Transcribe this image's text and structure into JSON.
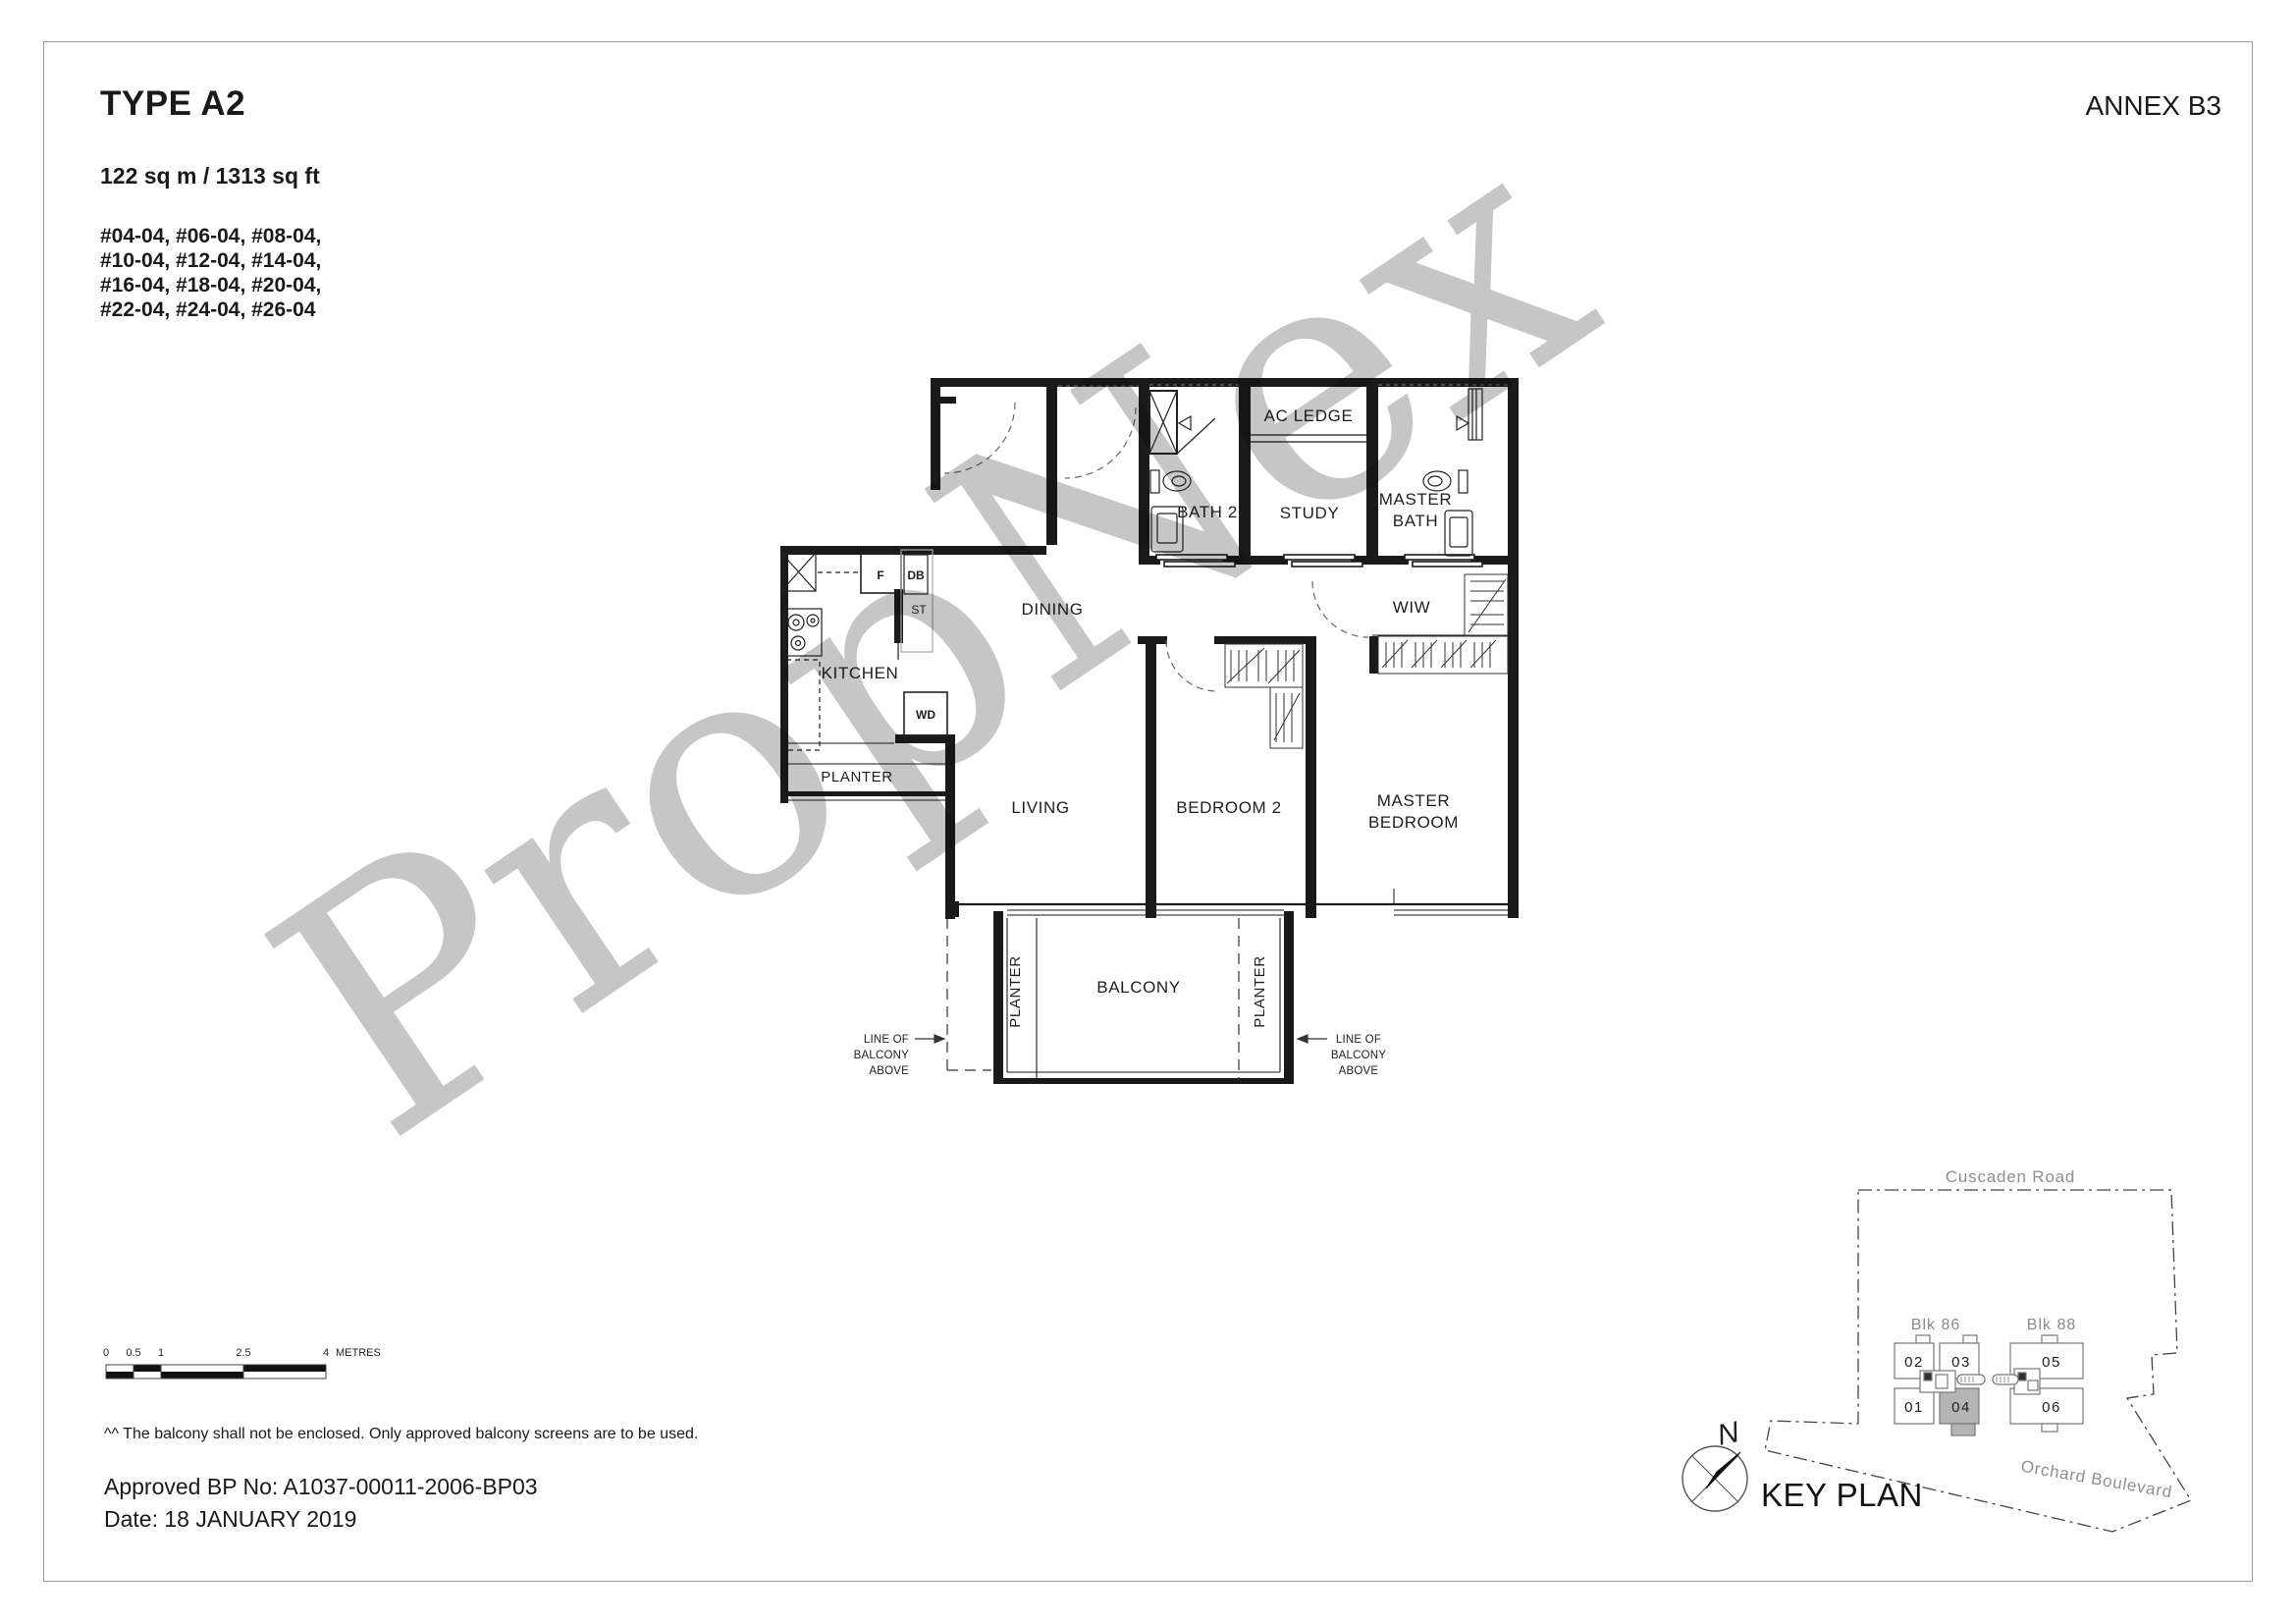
{
  "page": {
    "title": "TYPE A2",
    "annex": "ANNEX B3",
    "area": "122 sq m / 1313 sq ft",
    "units": [
      "#04-04, #06-04, #08-04,",
      "#10-04, #12-04, #14-04,",
      "#16-04, #18-04, #20-04,",
      "#22-04, #24-04, #26-04"
    ],
    "watermark": "PropNex",
    "note": "^^ The balcony shall not be enclosed. Only approved balcony screens are to be used.",
    "approval_bp": "Approved BP No: A1037-00011-2006-BP03",
    "approval_date": "Date: 18 JANUARY 2019"
  },
  "floorplan": {
    "rooms": {
      "ac_ledge": "AC LEDGE",
      "bath2": "BATH 2",
      "study": "STUDY",
      "master_bath": [
        "MASTER",
        "BATH"
      ],
      "dining": "DINING",
      "wiw": "WIW",
      "kitchen": "KITCHEN",
      "planter_kitchen": "PLANTER",
      "living": "LIVING",
      "bedroom2": "BEDROOM 2",
      "master_bedroom": [
        "MASTER",
        "BEDROOM"
      ],
      "balcony": "BALCONY",
      "planter_left": "PLANTER",
      "planter_right": "PLANTER"
    },
    "fixtures": {
      "fridge": "F",
      "distribution_board": "DB",
      "store": "ST",
      "washer_dryer": "WD"
    },
    "annotations": {
      "line_of_balcony_above": [
        "LINE OF",
        "BALCONY",
        "ABOVE"
      ]
    }
  },
  "scalebar": {
    "ticks": [
      "0",
      "0.5",
      "1",
      "2.5",
      "4"
    ],
    "unit": "METRES"
  },
  "keyplan": {
    "title": "KEY PLAN",
    "north_label": "N",
    "roads": {
      "top": "Cuscaden Road",
      "bottom": "Orchard Boulevard"
    },
    "blocks": [
      {
        "name": "Blk 86",
        "units": [
          "02",
          "03",
          "01",
          "04"
        ],
        "highlighted_unit": "04"
      },
      {
        "name": "Blk 88",
        "units": [
          "05",
          "06"
        ],
        "highlighted_unit": ""
      }
    ],
    "colors": {
      "highlight": "#b5b5b5",
      "wall": "#1a1a1a",
      "watermark": "#c6c6c6"
    }
  }
}
